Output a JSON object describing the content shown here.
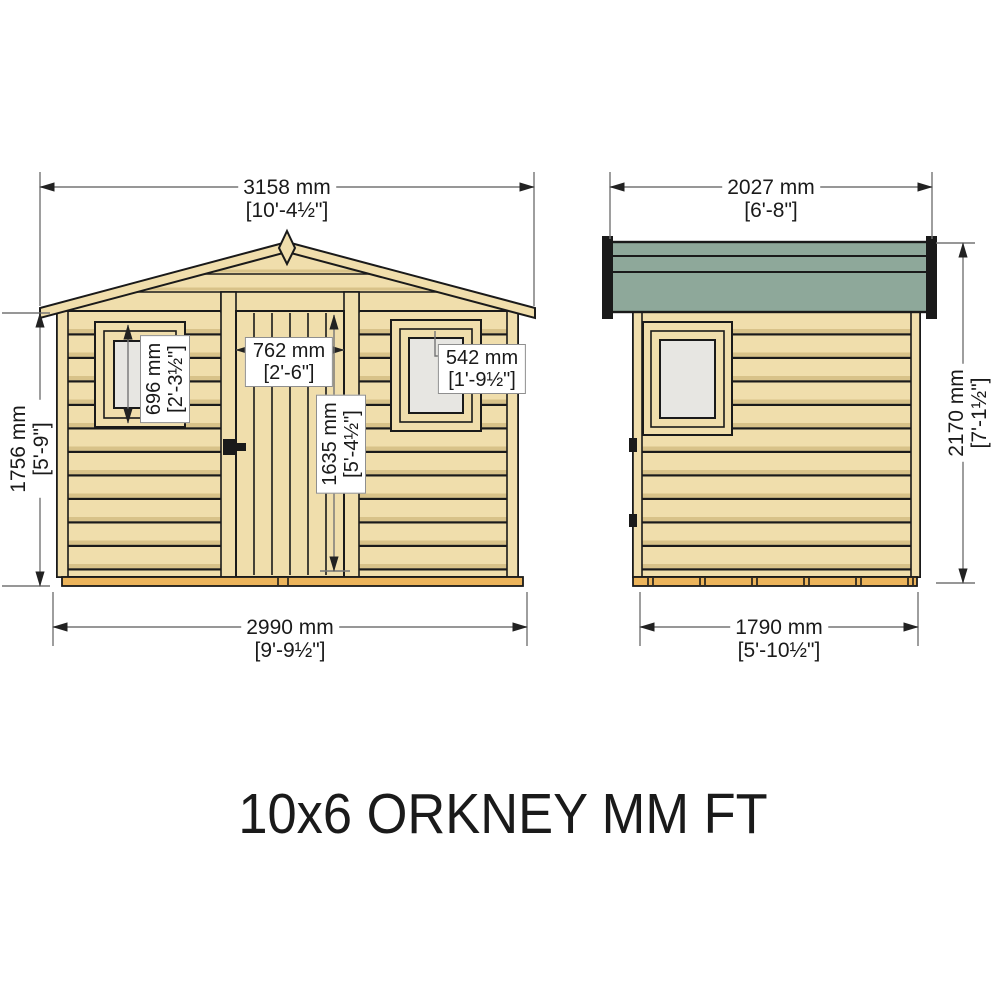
{
  "title": "10x6 ORKNEY MM FT",
  "front": {
    "overall_width": {
      "mm": "3158 mm",
      "ft": "[10'-4½\"]"
    },
    "base_width": {
      "mm": "2990 mm",
      "ft": "[9'-9½\"]"
    },
    "eaves_height": {
      "mm": "1756 mm",
      "ft": "[5'-9\"]"
    },
    "window_left": {
      "mm": "696 mm",
      "ft": "[2'-3½\"]"
    },
    "door_width": {
      "mm": "762 mm",
      "ft": "[2'-6\"]"
    },
    "door_height": {
      "mm": "1635 mm",
      "ft": "[5'-4½\"]"
    },
    "window_right": {
      "mm": "542 mm",
      "ft": "[1'-9½\"]"
    }
  },
  "side": {
    "overall_width": {
      "mm": "2027 mm",
      "ft": "[6'-8\"]"
    },
    "base_width": {
      "mm": "1790 mm",
      "ft": "[5'-10½\"]"
    },
    "overall_height": {
      "mm": "2170 mm",
      "ft": "[7'-1½\"]"
    }
  },
  "colors": {
    "wood": "#F0DEAC",
    "wood_shade": "#D8C289",
    "roof_green": "#8EA89A",
    "base_wood": "#ECB45B",
    "glass": "#E7E6E2",
    "outline": "#1A1A1A",
    "dim_line": "#757575",
    "arrow": "#222222"
  }
}
